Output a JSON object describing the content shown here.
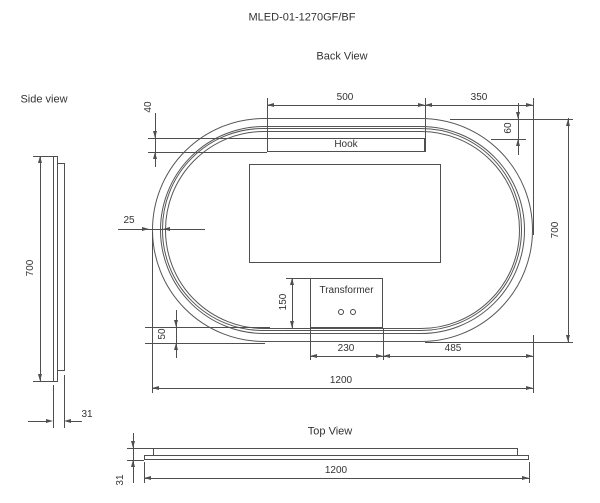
{
  "drawing": {
    "title": "MLED-01-1270GF/BF",
    "colors": {
      "line": "#4f4f4f",
      "text": "#333333"
    },
    "back_view": {
      "label": "Back View",
      "hook_label": "Hook",
      "transformer_label": "Transformer",
      "dims": {
        "hook_width": "500",
        "hook_offset_right": "350",
        "hook_bar_height": "40",
        "edge_to_hook": "60",
        "frame_thickness": "25",
        "height": "700",
        "transformer_height": "150",
        "bottom_frame_gap": "50",
        "transformer_width": "230",
        "transformer_offset_right": "485",
        "width": "1200"
      }
    },
    "side_view": {
      "label": "Side view",
      "dims": {
        "height": "700",
        "depth": "31"
      }
    },
    "top_view": {
      "label": "Top View",
      "dims": {
        "width": "1200",
        "depth": "31"
      }
    }
  }
}
